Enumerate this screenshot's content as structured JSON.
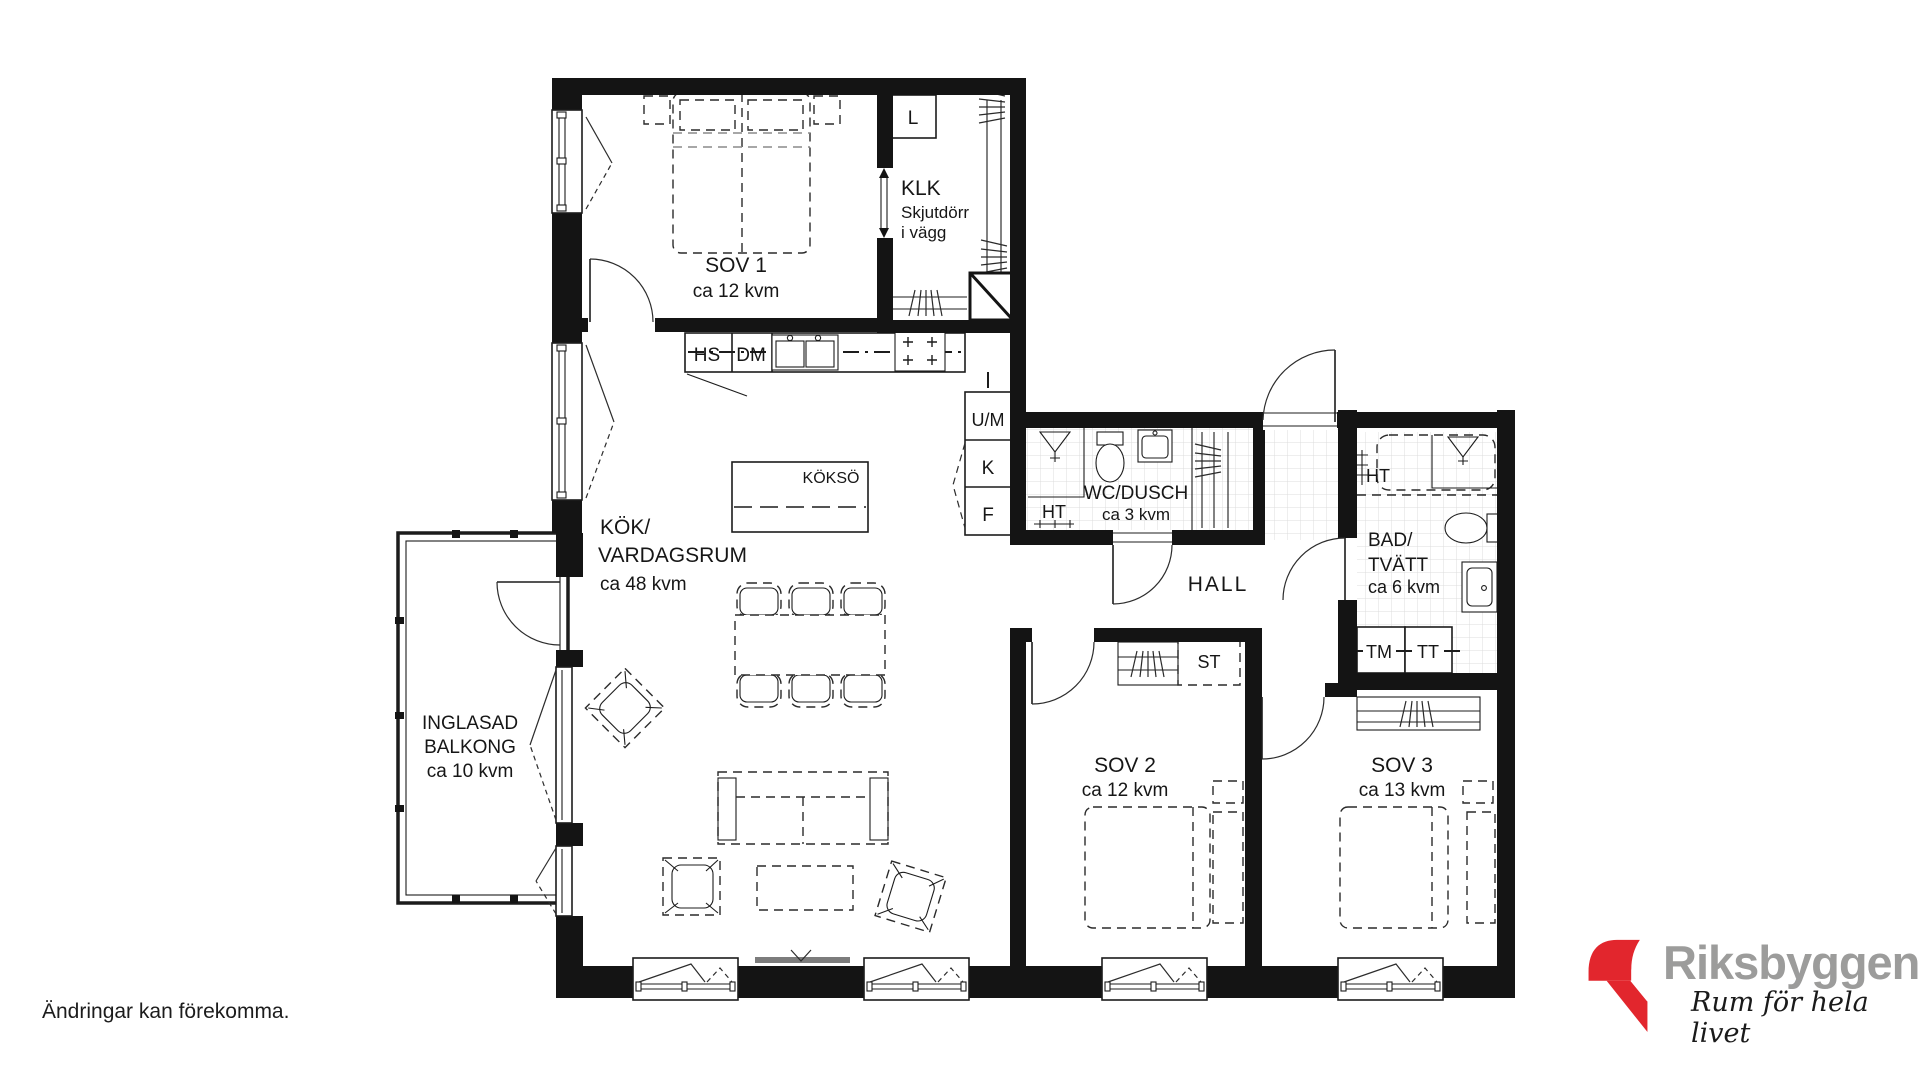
{
  "page": {
    "background": "#ffffff",
    "disclaimer": "Ändringar kan förekomma."
  },
  "brand": {
    "name": "Riksbyggen",
    "tagline": "Rum för hela livet",
    "red": "#E2262D",
    "gray": "#9C9C9B"
  },
  "rooms": {
    "sov1": {
      "name": "SOV 1",
      "area": "ca 12 kvm"
    },
    "klk": {
      "name": "KLK",
      "note_line1": "Skjutdörr",
      "note_line2": "i vägg"
    },
    "livingroom": {
      "line1": "KÖK/",
      "line2": "VARDAGSRUM",
      "area": "ca 48 kvm"
    },
    "balcony": {
      "line1": "INGLASAD",
      "line2": "BALKONG",
      "area": "ca 10 kvm"
    },
    "wc": {
      "name": "WC/DUSCH",
      "area": "ca 3 kvm"
    },
    "hall": {
      "name": "HALL"
    },
    "bath": {
      "line1": "BAD/",
      "line2": "TVÄTT",
      "area": "ca 6 kvm"
    },
    "sov2": {
      "name": "SOV 2",
      "area": "ca 12 kvm"
    },
    "sov3": {
      "name": "SOV 3",
      "area": "ca 13 kvm"
    }
  },
  "fixtures": {
    "linen_cabinet": "L",
    "tall_cabinet": "HS",
    "dishwasher": "DM",
    "oven_micro": "U/M",
    "fridge": "K",
    "freezer": "F",
    "kitchen_island": "KÖKSÖ",
    "towel_dryer_wc": "HT",
    "towel_dryer_bath": "HT",
    "cleaning_closet": "ST",
    "washing_machine": "TM",
    "tumble_dryer": "TT"
  }
}
